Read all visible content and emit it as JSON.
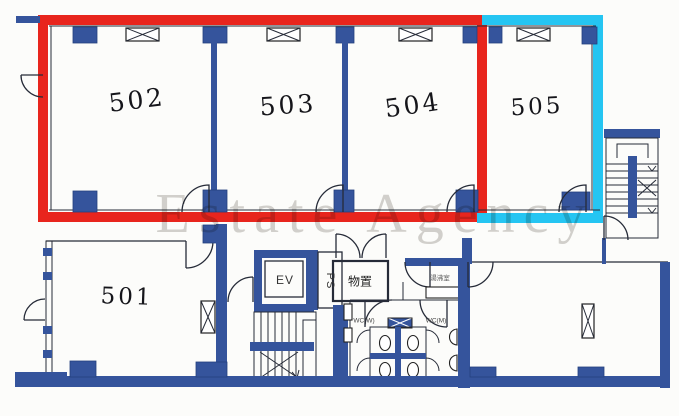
{
  "watermark": "Estate Agency",
  "rooms": [
    {
      "id": "501",
      "label": "501"
    },
    {
      "id": "502",
      "label": "502"
    },
    {
      "id": "503",
      "label": "503"
    },
    {
      "id": "504",
      "label": "504"
    },
    {
      "id": "505",
      "label": "505"
    }
  ],
  "facilities": {
    "elevator": "EV",
    "pipe_shaft": "PS",
    "storage": "物置",
    "kitchenette": "湯沸室",
    "wc_left": "WC(W)",
    "wc_right": "WC(M)"
  },
  "highlights": [
    {
      "name": "red-outline",
      "color": "#e8251d"
    },
    {
      "name": "cyan-outline",
      "color": "#25c5f2"
    }
  ],
  "colors": {
    "wall_blue": "#35549c",
    "highlight_red": "#e8251d",
    "highlight_cyan": "#25c5f2",
    "watermark_gray": "#b9b7b2",
    "line_dark": "#262b38"
  }
}
